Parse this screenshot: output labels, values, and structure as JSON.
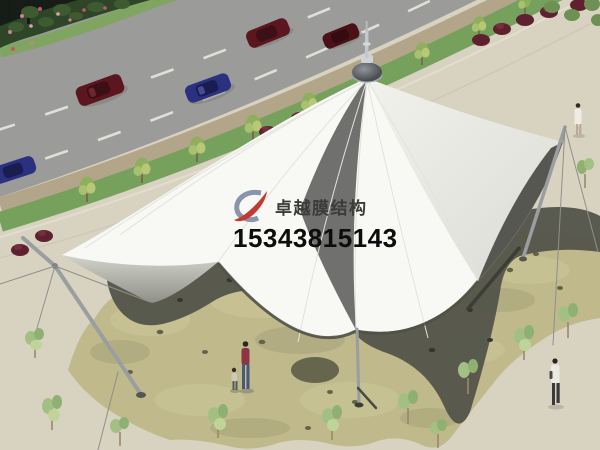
{
  "watermark": {
    "logo_icon": "zhuoyue-logo-swoosh",
    "company_name": "卓越膜结构",
    "phone_number": "15343815143"
  },
  "palette": {
    "pavement": "#d8d2c1",
    "road": "#9b9b99",
    "lane_marking": "#e9e7e1",
    "median_tan": "#b3a58a",
    "median_grass": "#76a15c",
    "hedge": "#2e4528",
    "membrane_white": "#f8f8f4",
    "membrane_underside": "#565750",
    "plaza_stone": "#bfb98c",
    "canopy_shadow": "#53544a",
    "mast_gray": "#9b9ea1",
    "tree_green": "#8fae5e",
    "bush_maroon": "#5f2130",
    "car_red": "#5c1620",
    "car_blue": "#2b3080",
    "logo_blue": "#8b95aa",
    "logo_red": "#c23a32",
    "company_text": "#3b3b3b",
    "phone_text": "#0d0d0d"
  }
}
